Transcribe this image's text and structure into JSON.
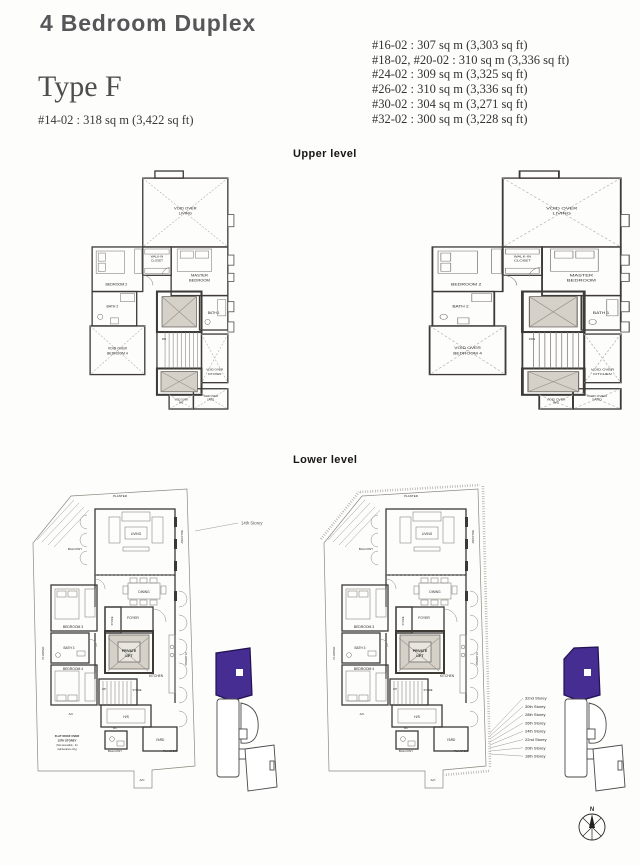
{
  "header": {
    "title": "4 Bedroom Duplex",
    "type": "Type F",
    "primary_unit": "#14-02 : 318 sq m (3,422 sq ft)",
    "unit_list": [
      "#16-02 : 307 sq m (3,303 sq ft)",
      "#18-02, #20-02 : 310 sq m (3,336 sq ft)",
      "#24-02 : 309 sq m (3,325 sq ft)",
      "#26-02 : 310 sq m (3,336 sq ft)",
      "#30-02 : 304 sq m (3,271 sq ft)",
      "#32-02 : 300 sq m (3,228 sq ft)"
    ]
  },
  "sections": {
    "upper_label": "Upper level",
    "lower_label": "Lower level"
  },
  "upper_plan": {
    "void_living": [
      "VOID OVER",
      "LIVING"
    ],
    "walk_in_closet": [
      "WALK-IN",
      "CLOSET"
    ],
    "master_bedroom": [
      "MASTER",
      "BEDROOM"
    ],
    "bedroom2": "BEDROOM 2",
    "bath2": "BATH 2",
    "bath1": "BATH 1",
    "void_bedroom4": [
      "VOID OVER",
      "BEDROOM 4"
    ],
    "dn": "DN",
    "void_kitchen": [
      "VOID OVER",
      "KITCHEN"
    ],
    "void_wc": [
      "VOID OVER",
      "WC"
    ],
    "void_yard": [
      "VOID OVER",
      "YARD"
    ]
  },
  "lower_plan": {
    "planter": "PLANTER",
    "balcony": "BALCONY",
    "living": "LIVING",
    "dining": "DINING",
    "bedroom3": "BEDROOM 3",
    "bath3": "BATH 3",
    "bedroom4": "BEDROOM 4",
    "foyer": "FOYER",
    "store": "STORE",
    "private_lift": [
      "PRIVATE",
      "LIFT"
    ],
    "kitchen": "KITCHEN",
    "up": "UP",
    "hs": "H/S",
    "wc": "WC",
    "yard": "YARD",
    "ac": "A/C"
  },
  "annotations": {
    "storey_14": "14th Storey",
    "flat_roof": [
      "FLAT ROOF OVER",
      "13TH STOREY",
      "(Not accessible - for",
      "maintenance only)"
    ],
    "storey_list": [
      "32nd Storey",
      "30th Storey",
      "28th Storey",
      "26th Storey",
      "24th Storey",
      "22nd Storey",
      "20th Storey",
      "18th Storey"
    ],
    "compass_n": "N"
  },
  "colors": {
    "accent_purple": "#462d92",
    "shaft_fill": "#d5d1c8"
  }
}
